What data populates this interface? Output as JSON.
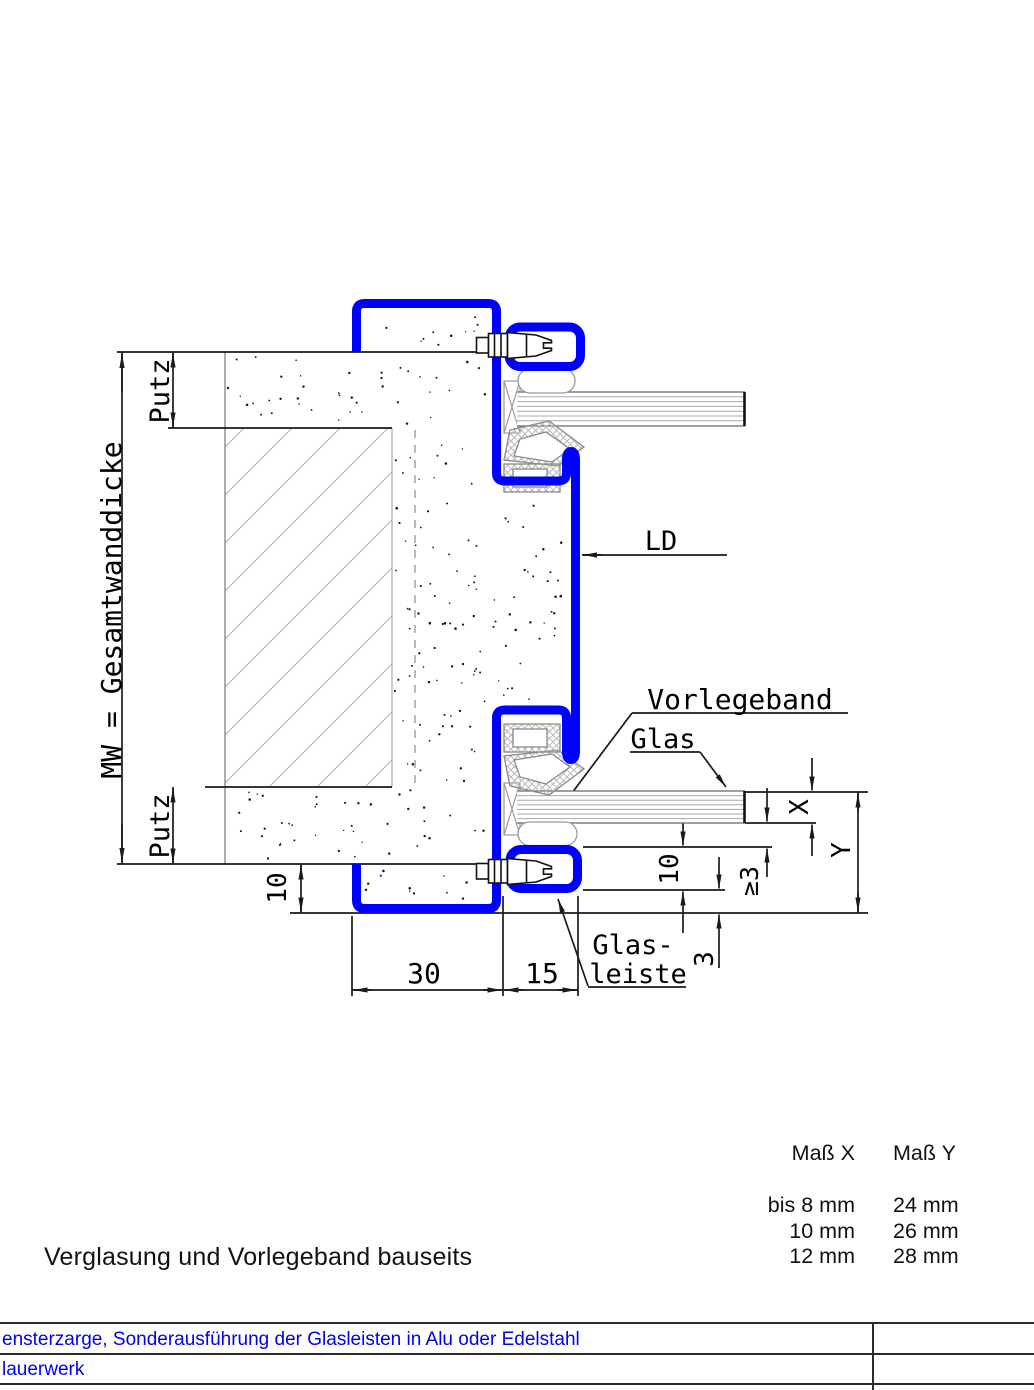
{
  "colors": {
    "frame_blue": "#0000FF",
    "footer_text": "#0000EE",
    "line_black": "#1a1a1a"
  },
  "labels": {
    "putz_top": "Putz",
    "mw_wall": "MW = Gesamtwanddicke",
    "putz_bottom": "Putz",
    "ld": "LD",
    "vorlegeband": "Vorlegeband",
    "glas": "Glas",
    "glasleiste_line1": "Glas-",
    "glasleiste_line2": "leiste"
  },
  "dimensions": {
    "frame_width": "30",
    "bead_width": "15",
    "bottom_overlap": "10",
    "bead_height": "10",
    "edge_clearance": "≥3",
    "gap": "3",
    "glass_thickness": "X",
    "rebate_height": "Y"
  },
  "size_table": {
    "col_x_header": "Maß X",
    "col_y_header": "Maß Y",
    "rows": [
      {
        "x": "bis 8 mm",
        "y": "24 mm"
      },
      {
        "x": "10 mm",
        "y": "26 mm"
      },
      {
        "x": "12 mm",
        "y": "28 mm"
      }
    ]
  },
  "caption": "Verglasung und Vorlegeband bauseits",
  "footer": {
    "row1": "ensterzarge, Sonderausführung der Glasleisten in Alu oder Edelstahl",
    "row2": "lauerwerk"
  }
}
